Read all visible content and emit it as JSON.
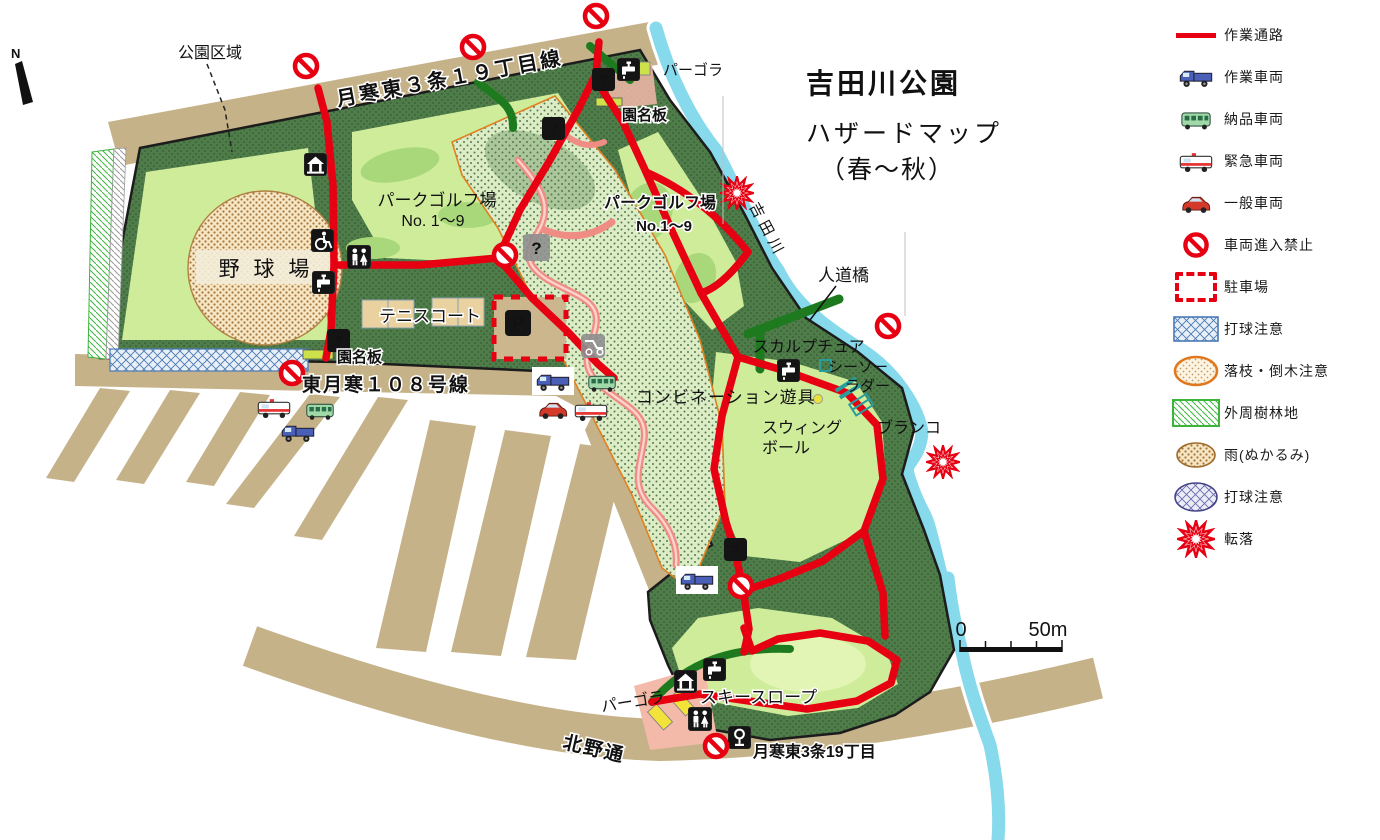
{
  "title": {
    "park_name": "吉田川公園",
    "map_type": "ハザードマップ",
    "season": "（春～秋）"
  },
  "compass": {
    "north": "N"
  },
  "scale_bar": {
    "min": "0",
    "max": "50m"
  },
  "legend": {
    "items": [
      {
        "symbol": "work-route-line",
        "label": "作業通路"
      },
      {
        "symbol": "work-truck",
        "label": "作業車両"
      },
      {
        "symbol": "delivery-bus",
        "label": "納品車両"
      },
      {
        "symbol": "ambulance",
        "label": "緊急車両"
      },
      {
        "symbol": "general-car",
        "label": "一般車両"
      },
      {
        "symbol": "no-entry-sign",
        "label": "車両進入禁止"
      },
      {
        "symbol": "parking-dashed-box",
        "label": "駐車場"
      },
      {
        "symbol": "blue-crosshatch-rect",
        "label": "打球注意"
      },
      {
        "symbol": "orange-dotted-ellipse",
        "label": "落枝・倒木注意"
      },
      {
        "symbol": "green-hatch-rect",
        "label": "外周樹林地"
      },
      {
        "symbol": "brown-dotted-ellipse",
        "label": "雨(ぬかるみ)"
      },
      {
        "symbol": "navy-crosshatch-ellipse",
        "label": "打球注意"
      },
      {
        "symbol": "fall-burst",
        "label": "転落"
      }
    ]
  },
  "map": {
    "labels": {
      "park_area": "公園区域",
      "road_north": "月寒東３条１９丁目線",
      "road_west": "東月寒１０８号線",
      "road_south": "北野通",
      "district_south": "月寒東3条19丁目",
      "river": "吉田川",
      "pergola_north": "パーゴラ",
      "pergola_south": "パーゴラ",
      "name_board_north": "園名板",
      "name_board_west": "園名板",
      "golf_west_line1": "パークゴルフ場",
      "golf_west_line2": "No. 1～9",
      "golf_east_line1": "パークゴルフ場",
      "golf_east_line2": "No.1～9",
      "baseball_field": "野 球 場",
      "tennis_court": "テニスコート",
      "footbridge": "人道橋",
      "sculpture": "スカルプチュア",
      "seesaw": "シーソー",
      "ladder": "ラダー",
      "combination_playground": "コンビネーション遊具",
      "swing_ball_line1": "スウィング",
      "swing_ball_line2": "ボール",
      "swing": "ブランコ",
      "ski_slope": "スキースロープ"
    },
    "icons": {
      "question": "?",
      "parking": "P"
    }
  }
}
